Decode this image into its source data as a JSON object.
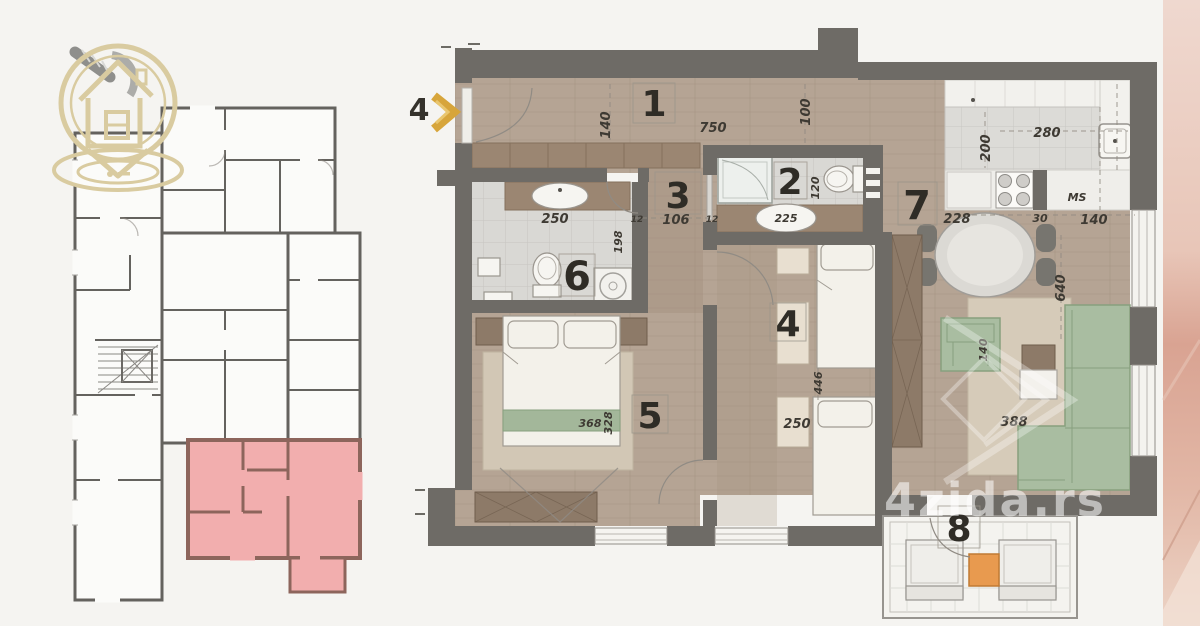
{
  "scene": {
    "background": "#f5f4f1",
    "highlight_pink": "#f2aeae",
    "logo_beige": "#d9cba0",
    "arrow_gold": "#d7a53b",
    "terrace_table_orange": "#e89a4f",
    "sofa_green": "#a9bda1",
    "wall_grey": "#6e6b66"
  },
  "watermark": {
    "text": "4zida.rs"
  },
  "entrance": {
    "number": "4"
  },
  "rooms": {
    "r1": "1",
    "r2": "2",
    "r3": "3",
    "r4": "4",
    "r5": "5",
    "r6": "6",
    "r7": "7",
    "r8": "8"
  },
  "dims": {
    "hall_len": "750",
    "hall_w": "140",
    "duct": "100",
    "bath2_w": "120",
    "bath2_sink": "225",
    "hall3_w": "106",
    "hall3_l": "12",
    "hall3_r": "12",
    "bath6_w": "250",
    "bath6_h": "198",
    "kit_w": "280",
    "kit_d": "200",
    "kit_a": "228",
    "kit_b": "30",
    "kit_c": "140",
    "kit_dw": "MS",
    "liv_h": "640",
    "liv_chair": "140",
    "liv_rug": "388",
    "b4_h": "446",
    "b4_w": "250",
    "b5_w": "368",
    "b5_h": "328"
  }
}
